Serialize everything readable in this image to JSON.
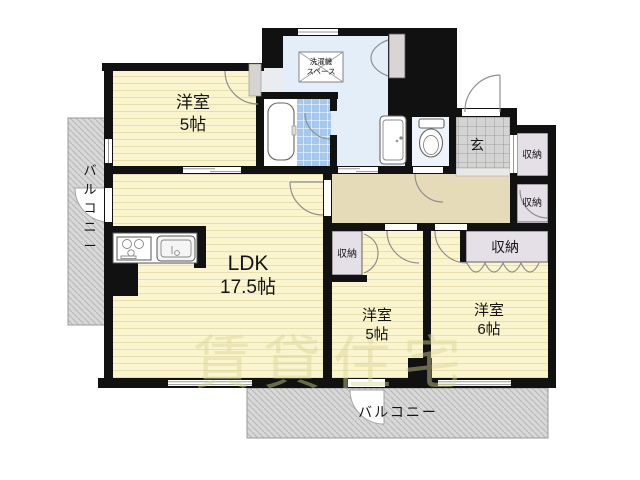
{
  "floorplan": {
    "watermark": "賃貸住宅",
    "rooms": {
      "bedroom_top_left": {
        "name": "洋室",
        "size": "5帖"
      },
      "ldk": {
        "name": "LDK",
        "size": "17.5帖"
      },
      "bedroom_middle": {
        "name": "洋室",
        "size": "5帖"
      },
      "bedroom_right": {
        "name": "洋室",
        "size": "6帖"
      }
    },
    "labels": {
      "balcony_left": "バルコニー",
      "balcony_bottom": "バルコニー",
      "entrance": "玄",
      "washer_space_line1": "洗濯機",
      "washer_space_line2": "スペース",
      "closet_hall_upper": "収納",
      "closet_hall_lower": "収納",
      "closet_bedroom_middle": "収納",
      "closet_bedroom_right": "収納"
    },
    "colors": {
      "wall": "#111111",
      "room_floor": "#faf4cf",
      "room_floor_stripe": "#e7dfae",
      "hallway_floor": "#e6dbb9",
      "washroom_floor": "#e4eef8",
      "toilet_floor": "#eef4fb",
      "bath_tile": "#a6c8ec",
      "entrance_tile": "#d4d4d4",
      "closet_fill": "#e5dfe8",
      "balcony_fill": "#d8d8d8",
      "watermark_color": "#d9d694"
    }
  }
}
